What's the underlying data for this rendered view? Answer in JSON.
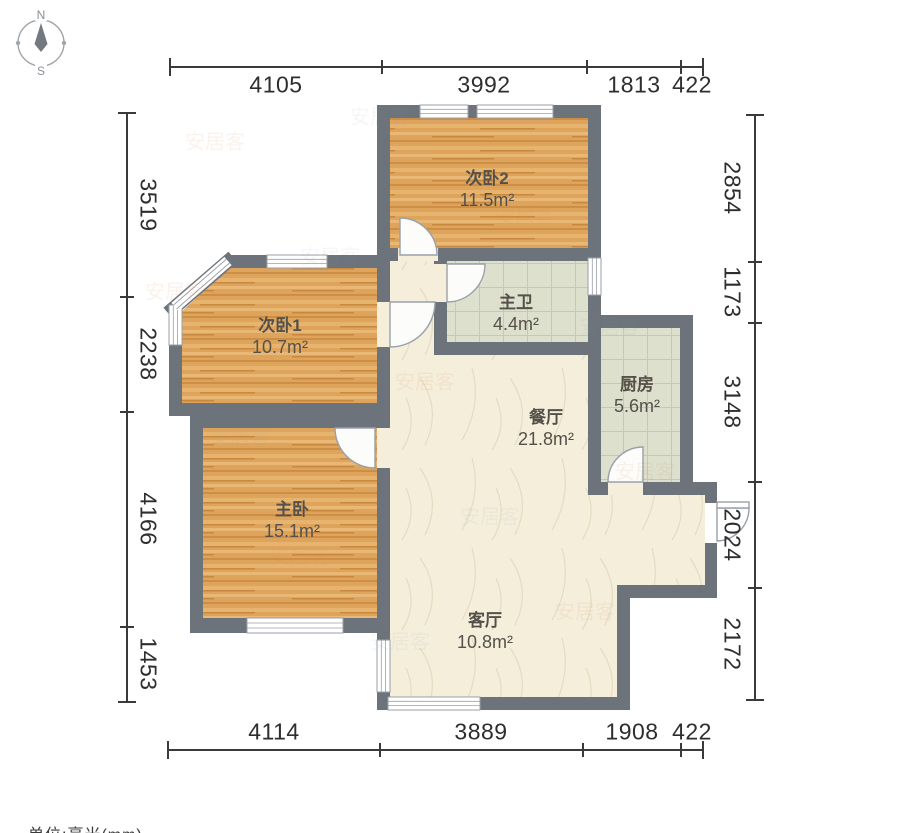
{
  "compass": {
    "north": "N",
    "south": "S"
  },
  "unit_note": "单位:毫米(mm)",
  "watermark": {
    "text": "安居客"
  },
  "rooms": {
    "bedroom2": {
      "name": "次卧2",
      "area": "11.5m²"
    },
    "bedroom1": {
      "name": "次卧1",
      "area": "10.7m²"
    },
    "master_bath": {
      "name": "主卫",
      "area": "4.4m²"
    },
    "kitchen": {
      "name": "厨房",
      "area": "5.6m²"
    },
    "dining": {
      "name": "餐厅",
      "area": "21.8m²"
    },
    "master_bedroom": {
      "name": "主卧",
      "area": "15.1m²"
    },
    "living": {
      "name": "客厅",
      "area": "10.8m²"
    }
  },
  "dimensions_mm": {
    "top": [
      "4105",
      "3992",
      "1813",
      "422"
    ],
    "bottom": [
      "4114",
      "3889",
      "1908",
      "422"
    ],
    "left": [
      "3519",
      "2238",
      "4166",
      "1453"
    ],
    "right": [
      "2854",
      "1173",
      "3148",
      "2024",
      "2172"
    ]
  },
  "colors": {
    "wall": "#6d737b",
    "wood_floor": "#dfa45c",
    "tile_floor": "#dce0cd",
    "marble_floor": "#f4eedb",
    "dimension_text": "#2e2e2e",
    "room_text": "#55514a"
  }
}
